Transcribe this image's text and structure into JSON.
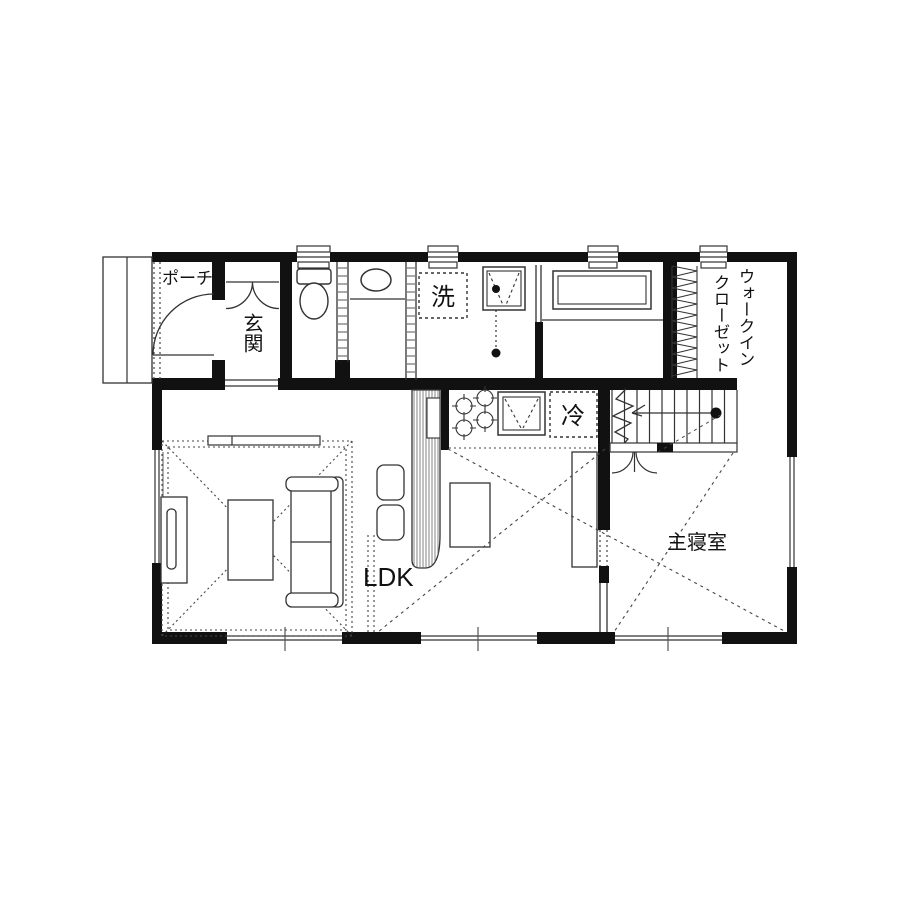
{
  "plan": {
    "title": "1F floor plan",
    "labels": {
      "porch": "ポーチ",
      "entrance": "玄関",
      "washer": "洗",
      "fridge": "冷",
      "ldk": "LDK",
      "master_bedroom": "主寝室",
      "wic_line1": "ウォークイン",
      "wic_line2": "クローゼット"
    },
    "rooms": [
      {
        "name": "porch"
      },
      {
        "name": "entrance-hall"
      },
      {
        "name": "toilet"
      },
      {
        "name": "powder-room"
      },
      {
        "name": "laundry-room"
      },
      {
        "name": "bathroom"
      },
      {
        "name": "walk-in-closet"
      },
      {
        "name": "ldk"
      },
      {
        "name": "kitchen"
      },
      {
        "name": "stairs"
      },
      {
        "name": "master-bedroom"
      }
    ],
    "colors": {
      "background": "#ffffff",
      "wall": "#111111",
      "line": "#333333",
      "dotted": "#444444"
    }
  }
}
